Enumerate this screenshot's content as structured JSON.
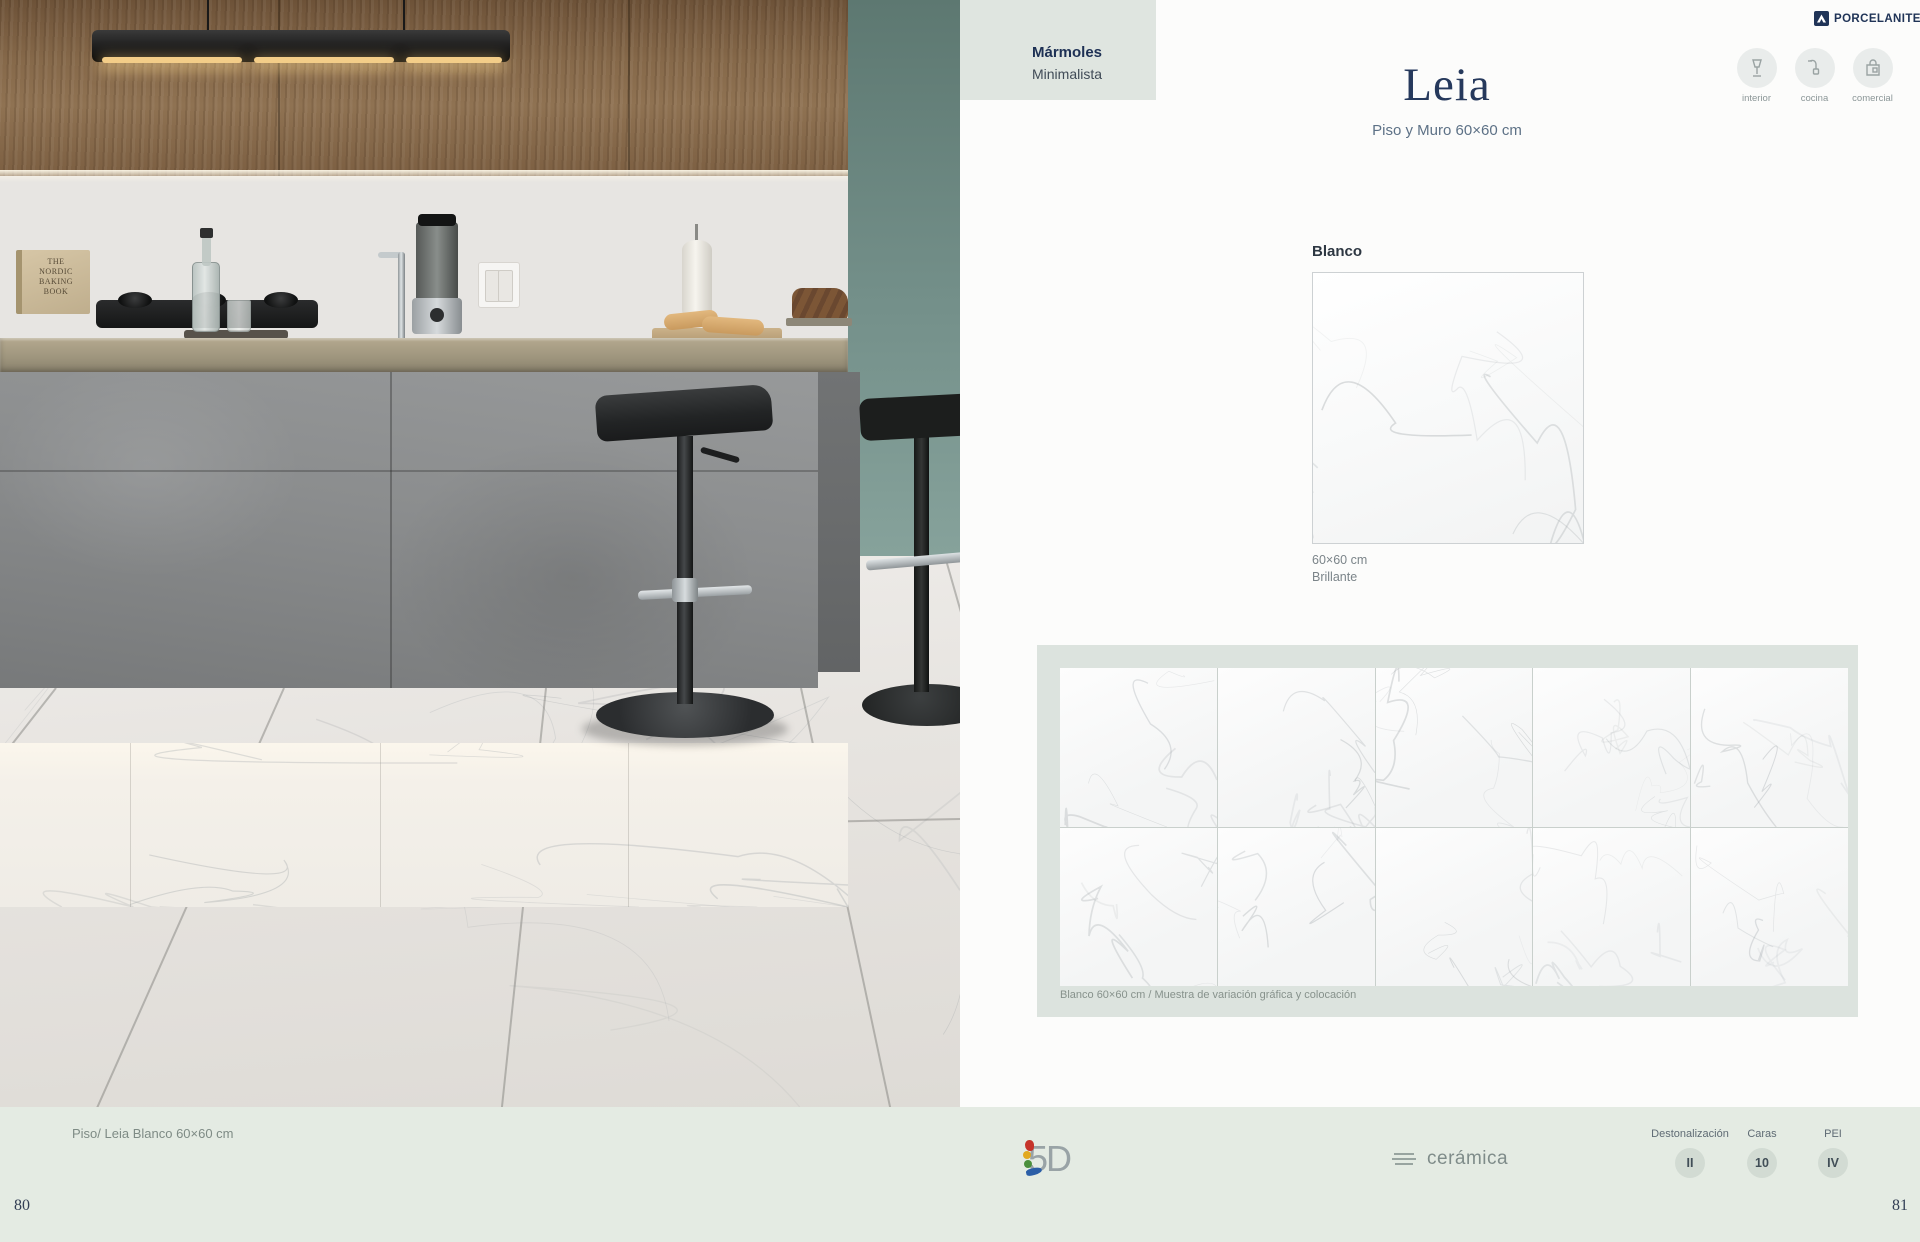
{
  "brand": {
    "name": "PORCELANITE",
    "registered": "®"
  },
  "left_page": {
    "book_title": "THE\nNORDIC\nBAKING\nBOOK",
    "page_number": "80"
  },
  "right_page": {
    "category_tab": {
      "title": "Mármoles",
      "subtitle": "Minimalista"
    },
    "product": {
      "title": "Leia",
      "subtitle": "Piso y Muro 60×60 cm"
    },
    "usage_icons": [
      {
        "icon": "lamp-icon",
        "label": "interior"
      },
      {
        "icon": "faucet-icon",
        "label": "cocina"
      },
      {
        "icon": "bag-icon",
        "label": "comercial"
      }
    ],
    "swatch": {
      "color_name": "Blanco",
      "size": "60×60 cm",
      "finish": "Brillante"
    },
    "variation_panel": {
      "caption": "Blanco 60×60 cm / Muestra de variación gráfica y colocación",
      "grid": {
        "columns": 5,
        "rows": 2
      }
    },
    "page_number": "81"
  },
  "footer": {
    "left_caption": "Piso/ Leia Blanco 60×60 cm",
    "tech_logo": "5D",
    "material_logo": "cerámica",
    "specs": [
      {
        "label": "Destonalización",
        "value": "II"
      },
      {
        "label": "Caras",
        "value": "10"
      },
      {
        "label": "PEI",
        "value": "IV"
      }
    ]
  },
  "colors": {
    "accent_navy": "#24395e",
    "page_bg": "#fcfcfb",
    "footer_sage": "#e4ebe3",
    "panel_sage": "#dce3de",
    "tab_sage": "#dfe5e0",
    "teal_wall": "#74908a",
    "badge_bg": "#d2dbd3"
  }
}
